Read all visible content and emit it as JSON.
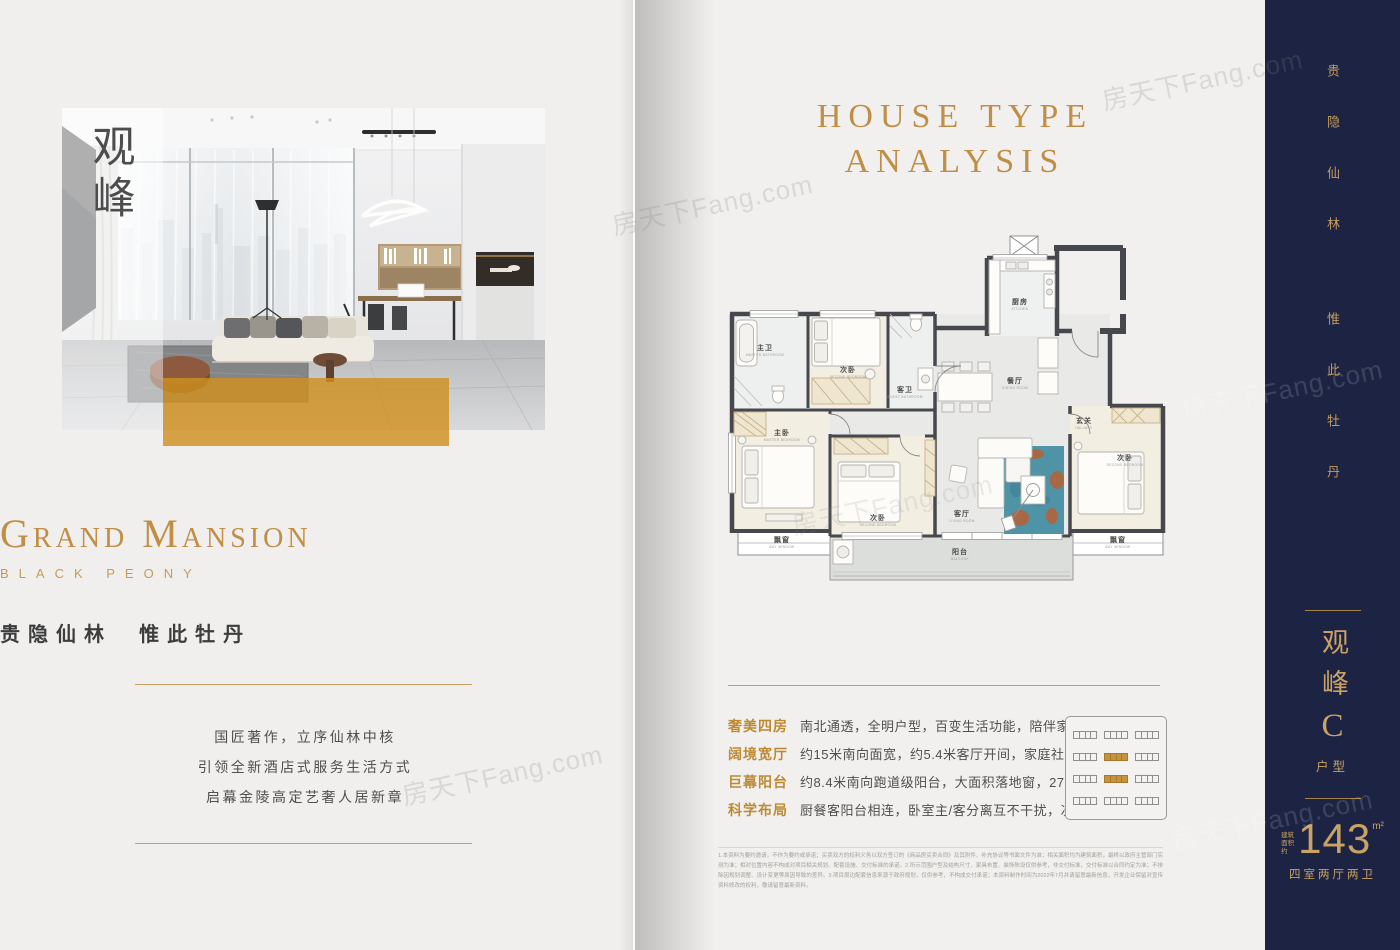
{
  "colors": {
    "gold_accent": "#c08e44",
    "gold_rule": "#c9a063",
    "navy_sidebar": "#1d2343",
    "photo_gold_overlay": "#d0911f",
    "rug_teal": "#4f93a6"
  },
  "watermark": {
    "text": "房天下Fang.com"
  },
  "left_page": {
    "photo_overlay_title": "观峰",
    "brand_title": "Grand Mansion",
    "brand_subtitle": "BLACK PEONY",
    "tagline": "贵隐仙林  惟此牡丹",
    "paragraphs": [
      "国匠著作，立序仙林中核",
      "引领全新酒店式服务生活方式",
      "启幕金陵高定艺奢人居新章"
    ]
  },
  "right_page": {
    "title_line1": "HOUSE TYPE",
    "title_line2": "ANALYSIS",
    "floorplan": {
      "rooms": [
        {
          "cn": "主卫",
          "en": "MASTER BATHROOM"
        },
        {
          "cn": "次卧",
          "en": "SECOND BEDROOM"
        },
        {
          "cn": "客卫",
          "en": "GUEST BATHROOM"
        },
        {
          "cn": "厨房",
          "en": "KITCHEN"
        },
        {
          "cn": "餐厅",
          "en": "DINING ROOM"
        },
        {
          "cn": "玄关",
          "en": "HALLWAY"
        },
        {
          "cn": "主卧",
          "en": "MASTER BEDROOM"
        },
        {
          "cn": "次卧",
          "en": "SECOND BEDROOM"
        },
        {
          "cn": "客厅",
          "en": "LIVING ROOM"
        },
        {
          "cn": "次卧",
          "en": "SECOND BEDROOM"
        },
        {
          "cn": "飘窗",
          "en": "BAY WINDOW"
        },
        {
          "cn": "飘窗",
          "en": "BAY WINDOW"
        },
        {
          "cn": "阳台",
          "en": "BALCONY"
        }
      ]
    },
    "features": [
      {
        "label": "奢美四房",
        "text": "南北通透，全明户型，百变生活功能，陪伴家庭全周期"
      },
      {
        "label": "阔境宽厅",
        "text": "约15米南向面宽，约5.4米客厅开间，家庭社交生活主场"
      },
      {
        "label": "巨幕阳台",
        "text": "约8.4米南向跑道级阳台，大面积落地窗，270°环幕视野"
      },
      {
        "label": "科学布局",
        "text": "厨餐客阳台相连，卧室主/客分离互不干扰，次卫干湿分离"
      }
    ],
    "siteplan": {
      "grid": [
        [
          "o",
          "o",
          "o"
        ],
        [
          "o",
          "g",
          "o"
        ],
        [
          "o",
          "g",
          "o"
        ],
        [
          "o",
          "o",
          "o"
        ]
      ]
    },
    "disclaimer": "1.本资料为要约邀请，不作为要约或承诺；买卖双方的权利义务以双方签订的《商品房买卖合同》及其附件、补充协议等书面文件为准；相关面积均为建筑面积，最终以政府主管部门实测为准；相对位置内容不构成对项目相关规划、配套设施、交付标准的承诺。2.所示范围户型及结构尺寸、家具布置、装饰陈设仅供参考，非交付标准，交付标准以合同约定为准；不排除因规划调整、设计变更等原因导致的差异。3.项目周边配套信息来源于政府规划，仅供参考，不构成交付承诺；本资料制作时间为2022年7月并请留意最新信息，开发企业保留对宣传资料修改的权利，敬请留意最新资料。"
  },
  "sidebar": {
    "vertical_motto_top": "贵隐仙林",
    "vertical_motto_bottom": "惟此牡丹",
    "type_name_vertical": "观峰",
    "type_letter": "C",
    "type_word": "户型",
    "area_prefix": "建筑面积约",
    "area_value": "143",
    "area_unit": "m²",
    "layout_label": "四室两厅两卫"
  }
}
